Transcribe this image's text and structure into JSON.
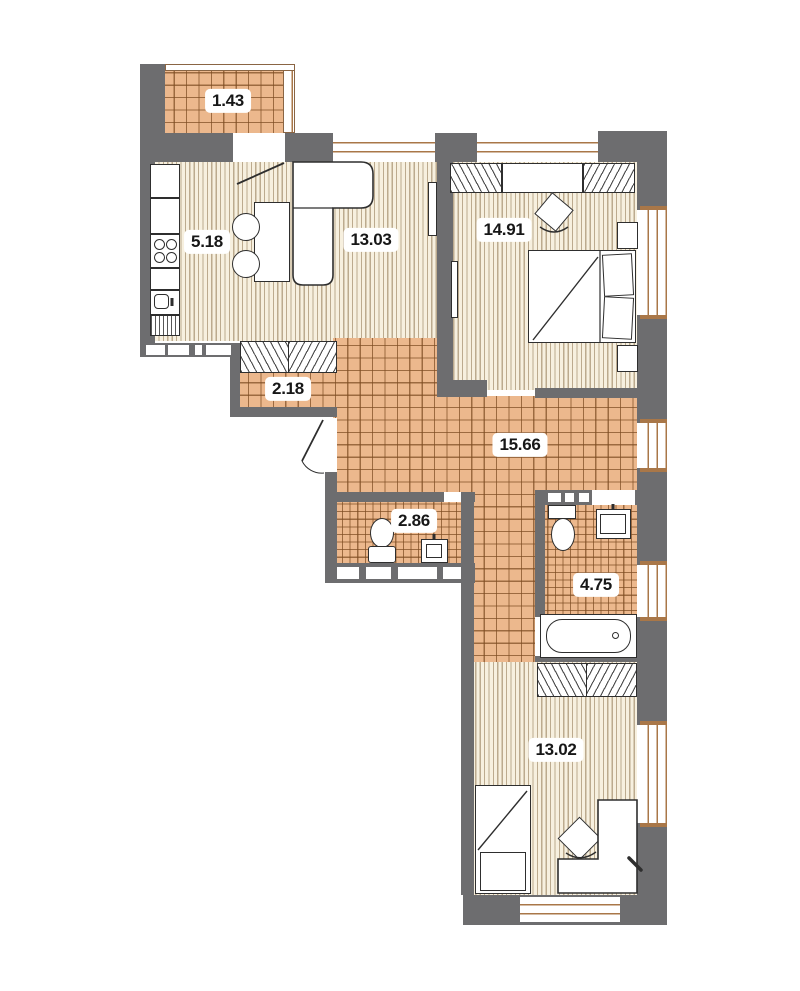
{
  "plan": {
    "type": "apartment-floor-plan",
    "rooms": [
      {
        "name": "balcony",
        "area": "1.43"
      },
      {
        "name": "kitchen",
        "area": "5.18"
      },
      {
        "name": "living-room",
        "area": "13.03"
      },
      {
        "name": "bedroom",
        "area": "14.91"
      },
      {
        "name": "hallway",
        "area": "2.18"
      },
      {
        "name": "corridor",
        "area": "15.66"
      },
      {
        "name": "wc",
        "area": "2.86"
      },
      {
        "name": "bathroom",
        "area": "4.75"
      },
      {
        "name": "bedroom-2",
        "area": "13.02"
      }
    ],
    "colors": {
      "wall": "#6d6d6f",
      "tile_floor": "#ecb88d",
      "tile_line": "#7d4c22",
      "wood_floor": "#f7f0df",
      "window_frame": "#a97748",
      "furniture_outline": "#2e2e2e",
      "background": "#ffffff"
    }
  }
}
